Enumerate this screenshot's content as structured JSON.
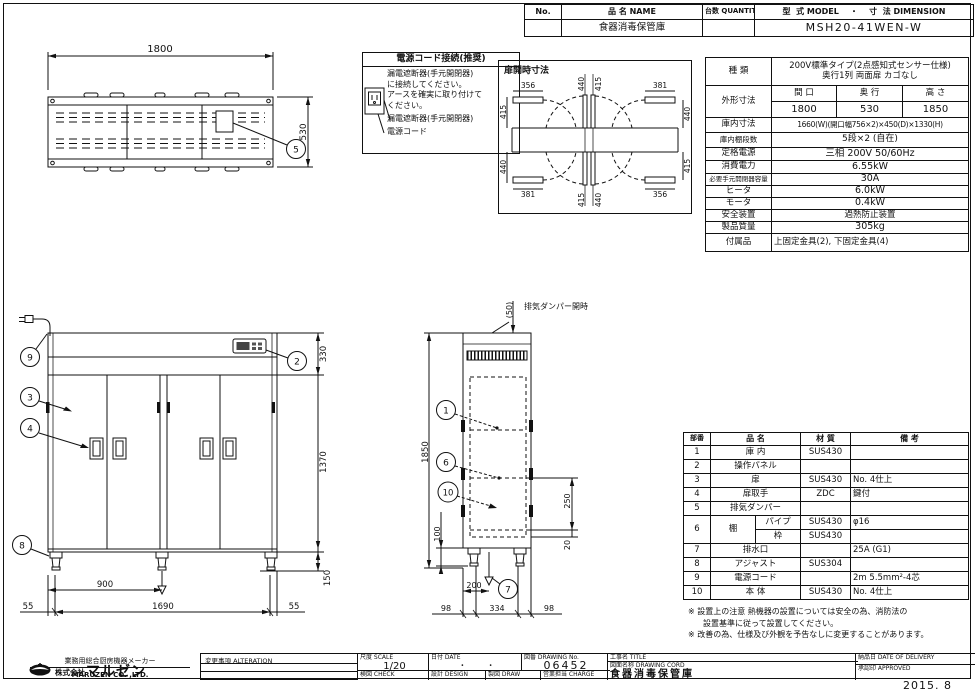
{
  "header": {
    "no_label": "No.",
    "name_label": "品  名 NAME",
    "qty_label": "台数 QUANTITY",
    "model_label": "型  式 MODEL    ・    寸  法 DIMENSION",
    "name_value": "食器消毒保管庫",
    "model_value": "MSH20-41WEN-W"
  },
  "spec": {
    "kind_label": "種  類",
    "kind_value_1": "200V標準タイプ(2点感知式センサー仕様)",
    "kind_value_2": "奥行1列 両面扉 カゴなし",
    "outer_label": "外形寸法",
    "outer_col_1": "間 口",
    "outer_col_2": "奥 行",
    "outer_col_3": "高 さ",
    "outer_val_1": "1800",
    "outer_val_2": "530",
    "outer_val_3": "1850",
    "inner_label": "庫内寸法",
    "inner_value": "1660(W)(開口幅756×2)×450(D)×1330(H)",
    "shelf_label": "庫内棚段数",
    "shelf_value": "5段×2 (自在)",
    "power_label": "定格電源",
    "power_value": "三相 200V 50/60Hz",
    "consumption_label": "消費電力",
    "consumption_value": "6.55kW",
    "breaker_label": "必要手元開閉器容量",
    "breaker_value": "30A",
    "heater_label": "ヒータ",
    "heater_value": "6.0kW",
    "motor_label": "モータ",
    "motor_value": "0.4kW",
    "safety_label": "安全装置",
    "safety_value": "過熱防止装置",
    "weight_label": "製品質量",
    "weight_value": "305kg",
    "accessory_label": "付属品",
    "accessory_value": "上固定金具(2), 下固定金具(4)"
  },
  "parts": {
    "headers": {
      "no": "部番",
      "name": "品  名",
      "material": "材  質",
      "note": "備  考"
    },
    "rows": [
      {
        "no": "1",
        "name": "庫 内",
        "material": "SUS430",
        "note": ""
      },
      {
        "no": "2",
        "name": "操作パネル",
        "material": "",
        "note": ""
      },
      {
        "no": "3",
        "name": "扉",
        "material": "SUS430",
        "note": "No. 4仕上"
      },
      {
        "no": "4",
        "name": "扉取手",
        "material": "ZDC",
        "note": "鍵付"
      },
      {
        "no": "5",
        "name": "排気ダンパー",
        "material": "",
        "note": ""
      }
    ],
    "row6": {
      "no": "6",
      "name": "棚",
      "sub1": {
        "name": "パイプ",
        "material": "SUS430",
        "note": "φ16"
      },
      "sub2": {
        "name": "枠",
        "material": "SUS430",
        "note": ""
      }
    },
    "rows2": [
      {
        "no": "7",
        "name": "排水口",
        "material": "",
        "note": "25A (G1)"
      },
      {
        "no": "8",
        "name": "アジャスト",
        "material": "SUS304",
        "note": ""
      },
      {
        "no": "9",
        "name": "電源コード",
        "material": "",
        "note": "2m 5.5mm²-4芯"
      },
      {
        "no": "10",
        "name": "本 体",
        "material": "SUS430",
        "note": "No. 4仕上"
      }
    ]
  },
  "notes": {
    "line1": "※ 設置上の注意 熱機器の設置については安全の為、消防法の",
    "line2": "設置基準に従って設置してください。",
    "line3": "※ 改善の為、仕様及び外観を予告なしに変更することがあります。"
  },
  "power_box": {
    "title": "電源コード接続(推奨)",
    "line1": "漏電遮断器(手元開閉器)",
    "line2": "に接続してください。",
    "line3": "アースを確実に取り付けて",
    "line4": "ください。",
    "breaker_label": "漏電遮断器(手元開閉器)",
    "cord_label": "電源コード"
  },
  "top_view": {
    "dim_1800": "1800",
    "dim_530": "530",
    "callout_5": "5"
  },
  "door_open": {
    "title": "扉開時寸法",
    "top": {
      "left_w": "356",
      "c1": "440",
      "c2": "415",
      "right_w": "381",
      "left_e": "415",
      "right_e": "440"
    },
    "bottom": {
      "left_w": "381",
      "c1": "415",
      "c2": "440",
      "right_w": "356",
      "left_e": "440",
      "right_e": "415"
    }
  },
  "front_view": {
    "dim_330": "330",
    "dim_1370": "1370",
    "dim_150": "150",
    "dim_900": "900",
    "dim_1690": "1690",
    "dim_55_left": "55",
    "dim_55_right": "55",
    "callout_9": "9",
    "callout_2": "2",
    "callout_3": "3",
    "callout_4": "4",
    "callout_8": "8"
  },
  "side_view": {
    "damper_label": "排気ダンパー開時",
    "dim_50": "(50)",
    "dim_1850": "1850",
    "dim_100": "100",
    "dim_250": "250",
    "dim_20": "20",
    "dim_200": "200",
    "dim_98_left": "98",
    "dim_334": "334",
    "dim_98_right": "98",
    "callout_1": "1",
    "callout_6": "6",
    "callout_10": "10",
    "callout_7": "7"
  },
  "title_block": {
    "tagline": "業務用総合厨房機器メーカー",
    "company_prefix": "株式会社",
    "company": "マルゼン",
    "company_en": "MARUZEN  CO. ,LTD.",
    "alteration_label": "変更事項  ALTERATION",
    "scale_label": "尺度  SCALE",
    "scale_value": "1/20",
    "date_label": "日付  DATE",
    "date_value": "・        ・",
    "drawing_no_label": "図番  DRAWING No.",
    "drawing_no_value": "06452",
    "title_label": "工事名  TITLE",
    "check_label": "検図  CHECK",
    "design_label": "設計  DESIGN",
    "draw_label": "製図  DRAW",
    "charge_label": "営業担当 CHARGE",
    "drawing_name_label": "図面名称  DRAWING CORD",
    "drawing_name_value": "食器消毒保管庫",
    "delivery_label": "納品日  DATE OF DELIVERY",
    "approved_label": "承認印  APPROVED",
    "issue_date": "2015. 8"
  }
}
